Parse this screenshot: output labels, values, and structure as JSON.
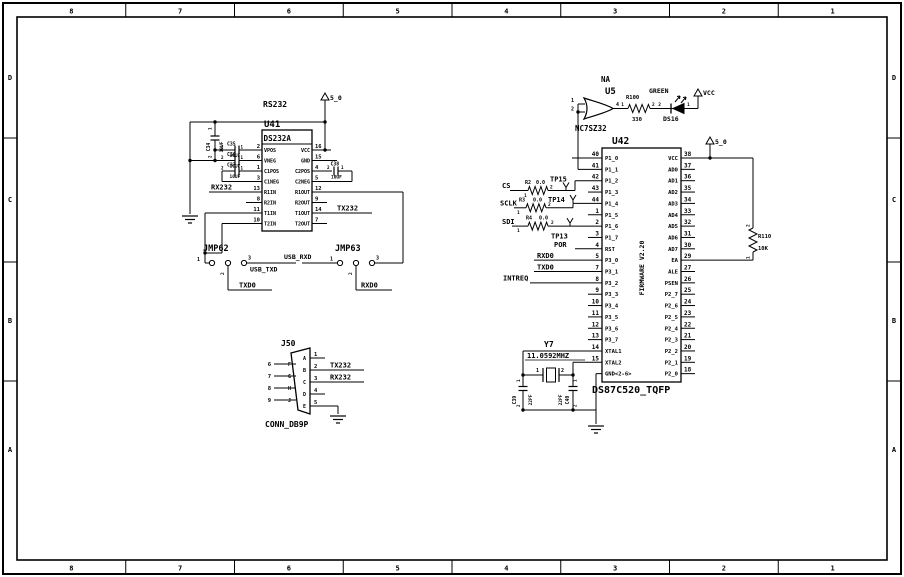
{
  "border": {
    "cols": [
      "8",
      "7",
      "6",
      "5",
      "4",
      "3",
      "2",
      "1"
    ],
    "rows": [
      "D",
      "C",
      "B",
      "A"
    ]
  },
  "colors": {
    "ink": "#000000",
    "paper": "#ffffff"
  },
  "rs232_section": {
    "title": "RS232",
    "power": "5_0"
  },
  "u41": {
    "ref": "U41",
    "part": "DS232A",
    "pins_left": [
      {
        "n": "2",
        "name": "VPOS"
      },
      {
        "n": "6",
        "name": "VNEG"
      },
      {
        "n": "1",
        "name": "C1POS"
      },
      {
        "n": "3",
        "name": "C1NEG"
      },
      {
        "n": "13",
        "name": "R1IN"
      },
      {
        "n": "8",
        "name": "R2IN"
      },
      {
        "n": "11",
        "name": "T1IN"
      },
      {
        "n": "10",
        "name": "T2IN"
      }
    ],
    "pins_right": [
      {
        "n": "16",
        "name": "VCC"
      },
      {
        "n": "15",
        "name": "GND"
      },
      {
        "n": "4",
        "name": "C2POS"
      },
      {
        "n": "5",
        "name": "C2NEG"
      },
      {
        "n": "12",
        "name": "R1OUT"
      },
      {
        "n": "9",
        "name": "R2OUT"
      },
      {
        "n": "14",
        "name": "T1OUT"
      },
      {
        "n": "7",
        "name": "T2OUT"
      }
    ]
  },
  "caps": {
    "c34": {
      "ref": "C34",
      "val": "10UF",
      "p1": "1",
      "p2": "2"
    },
    "c35": {
      "ref": "C35",
      "val": "10UF",
      "p1": "1",
      "p2": "2"
    },
    "c36": {
      "ref": "C36",
      "val": "10UF",
      "p1": "1",
      "p2": "2"
    },
    "c37": {
      "ref": "C37",
      "val": "10UF",
      "p1": "1",
      "p2": "2"
    },
    "c38": {
      "ref": "C38",
      "val": "10UF",
      "p1": "1",
      "p2": "2"
    },
    "c39": {
      "ref": "C39",
      "val": "22PF",
      "p1": "1",
      "p2": "2"
    },
    "c40": {
      "ref": "C40",
      "val": "22PF",
      "p1": "1",
      "p2": "2"
    }
  },
  "nets": {
    "rx232": "RX232",
    "tx232": "TX232",
    "usb_txd": "USB_TXD",
    "usb_rxd": "USB_RXD",
    "txd0": "TXD0",
    "rxd0": "RXD0",
    "cs": "CS",
    "sclk": "SCLK",
    "sdi": "SDI",
    "por": "POR",
    "intreq": "INTREQ"
  },
  "jmp62": {
    "ref": "JMP62",
    "p1": "1",
    "p2": "2",
    "p3": "3"
  },
  "jmp63": {
    "ref": "JMP63",
    "p1": "1",
    "p2": "2",
    "p3": "3"
  },
  "j50": {
    "ref": "J50",
    "part": "CONN_DB9P",
    "pins_right": [
      {
        "n": "1",
        "l": "A"
      },
      {
        "n": "2",
        "l": "B"
      },
      {
        "n": "3",
        "l": "C"
      },
      {
        "n": "4",
        "l": "D"
      },
      {
        "n": "5",
        "l": "E"
      }
    ],
    "pins_left": [
      {
        "n": "6",
        "l": "F"
      },
      {
        "n": "7",
        "l": "G"
      },
      {
        "n": "8",
        "l": "H"
      },
      {
        "n": "9",
        "l": "J"
      }
    ]
  },
  "u5": {
    "ref": "U5",
    "part": "NC7SZ32",
    "tag": "NA",
    "pin_in1": "1",
    "pin_in2": "2",
    "pin_out": "4"
  },
  "r100": {
    "ref": "R100",
    "val": "330",
    "p1": "1",
    "p2": "2"
  },
  "ds16": {
    "ref": "DS16",
    "color": "GREEN",
    "p1": "1",
    "p2": "2",
    "power": "VCC"
  },
  "r110": {
    "ref": "R110",
    "val": "10K",
    "p1": "1",
    "p2": "2"
  },
  "rnet": {
    "r2": {
      "ref": "R2",
      "val": "0.0",
      "p1": "1",
      "p2": "2"
    },
    "r3": {
      "ref": "R3",
      "val": "0.0",
      "p1": "1",
      "p2": "2"
    },
    "r4": {
      "ref": "R4",
      "val": "0.0",
      "p1": "1",
      "p2": "2"
    }
  },
  "tp": {
    "tp13": "TP13",
    "tp14": "TP14",
    "tp15": "TP15"
  },
  "u42": {
    "ref": "U42",
    "part": "DS87C520_TQFP",
    "firmware": "FIRMWARE V2.20",
    "power": "5_0",
    "pins_left": [
      {
        "n": "40",
        "name": "P1_0"
      },
      {
        "n": "41",
        "name": "P1_1"
      },
      {
        "n": "42",
        "name": "P1_2"
      },
      {
        "n": "43",
        "name": "P1_3"
      },
      {
        "n": "44",
        "name": "P1_4"
      },
      {
        "n": "1",
        "name": "P1_5"
      },
      {
        "n": "2",
        "name": "P1_6"
      },
      {
        "n": "3",
        "name": "P1_7"
      },
      {
        "n": "4",
        "name": "RST"
      },
      {
        "n": "5",
        "name": "P3_0"
      },
      {
        "n": "7",
        "name": "P3_1"
      },
      {
        "n": "8",
        "name": "P3_2"
      },
      {
        "n": "9",
        "name": "P3_3"
      },
      {
        "n": "10",
        "name": "P3_4"
      },
      {
        "n": "11",
        "name": "P3_5"
      },
      {
        "n": "12",
        "name": "P3_6"
      },
      {
        "n": "13",
        "name": "P3_7"
      },
      {
        "n": "14",
        "name": "XTAL1"
      },
      {
        "n": "15",
        "name": "XTAL2"
      },
      {
        "n": "",
        "name": "GND<2-6>"
      }
    ],
    "pins_right": [
      {
        "n": "38",
        "name": "VCC"
      },
      {
        "n": "37",
        "name": "AD0"
      },
      {
        "n": "36",
        "name": "AD1"
      },
      {
        "n": "35",
        "name": "AD2"
      },
      {
        "n": "34",
        "name": "AD3"
      },
      {
        "n": "33",
        "name": "AD4"
      },
      {
        "n": "32",
        "name": "AD5"
      },
      {
        "n": "31",
        "name": "AD6"
      },
      {
        "n": "30",
        "name": "AD7"
      },
      {
        "n": "29",
        "name": "EA"
      },
      {
        "n": "27",
        "name": "ALE"
      },
      {
        "n": "26",
        "name": "PSEN"
      },
      {
        "n": "25",
        "name": "P2_7"
      },
      {
        "n": "24",
        "name": "P2_6"
      },
      {
        "n": "23",
        "name": "P2_5"
      },
      {
        "n": "22",
        "name": "P2_4"
      },
      {
        "n": "21",
        "name": "P2_3"
      },
      {
        "n": "20",
        "name": "P2_2"
      },
      {
        "n": "19",
        "name": "P2_1"
      },
      {
        "n": "18",
        "name": "P2_0"
      }
    ]
  },
  "y7": {
    "ref": "Y7",
    "freq": "11.0592MHZ",
    "p1": "1",
    "p2": "2"
  }
}
